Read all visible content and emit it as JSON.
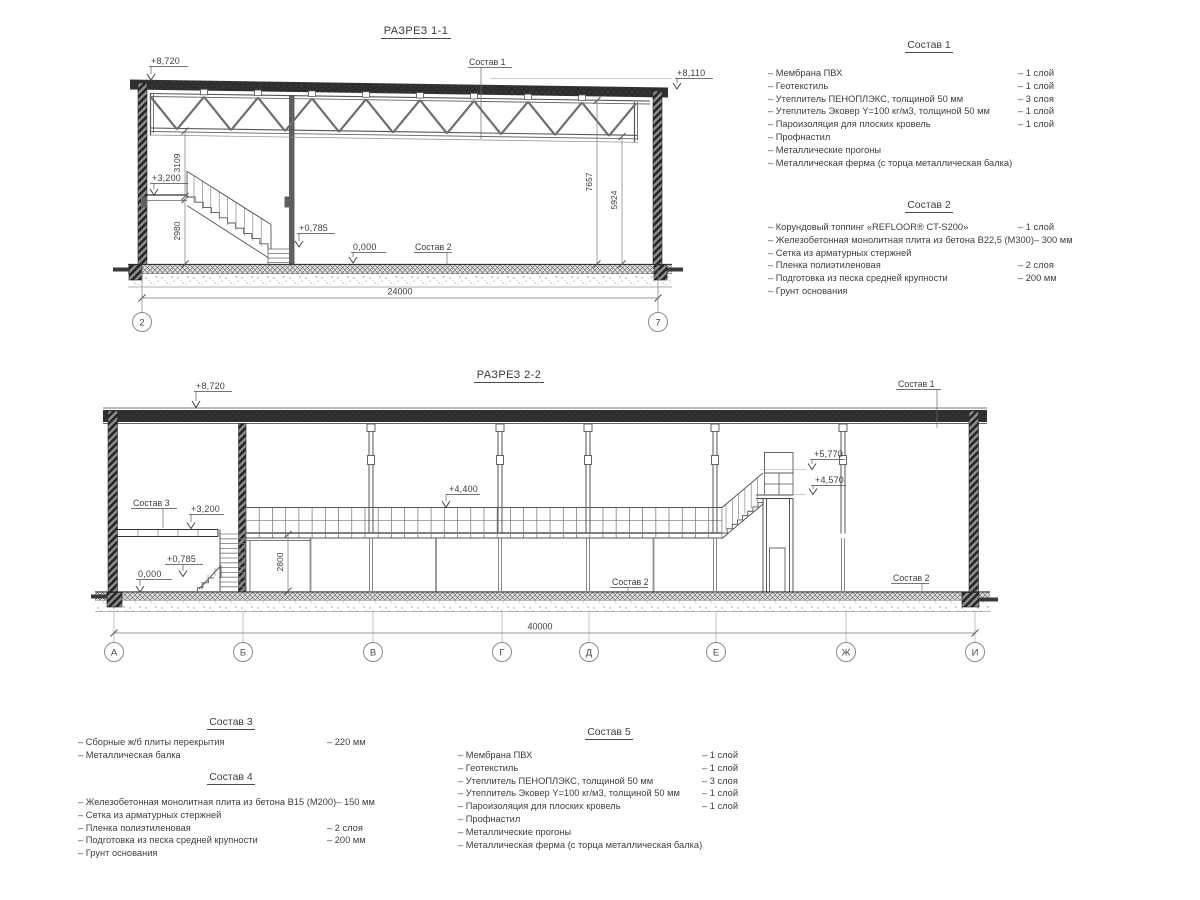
{
  "s11": {
    "title": "РАЗРЕЗ 1-1",
    "levels": {
      "roof_left": "+8,720",
      "roof_right": "+8,110",
      "landing": "+3,200",
      "stair": "+0,785",
      "floor": "0,000"
    },
    "callouts": {
      "roof": "Состав 1",
      "floor": "Состав 2"
    },
    "dims": {
      "truss_to_landing": "3109",
      "landing_to_floor": "2980",
      "right_outer": "7657",
      "right_inner": "5924",
      "span": "24000"
    },
    "grids": [
      "2",
      "7"
    ]
  },
  "s22": {
    "title": "РАЗРЕЗ 2-2",
    "levels": {
      "roof": "+8,720",
      "walkway": "+4,400",
      "stair_rail": "+5,770",
      "stair_platform": "+4,570",
      "mezzanine": "+3,200",
      "stair": "+0,785",
      "floor": "0,000"
    },
    "callouts": {
      "roof": "Состав 1",
      "mezzanine": "Состав 3",
      "floor_left": "Состав 2",
      "floor_right": "Состав 2"
    },
    "dims": {
      "span": "40000",
      "door": "2800"
    },
    "grids": [
      "А",
      "Б",
      "В",
      "Г",
      "Д",
      "Е",
      "Ж",
      "И"
    ]
  },
  "legends": [
    {
      "title": "Состав 1",
      "items": [
        {
          "name": "– Мембрана ПВХ",
          "qty": "– 1 слой"
        },
        {
          "name": "– Геотекстиль",
          "qty": "– 1 слой"
        },
        {
          "name": "– Утеплитель ПЕНОПЛЭКС, толщиной 50 мм",
          "qty": "– 3 слоя"
        },
        {
          "name": "– Утеплитель Эковер Y=100 кг/м3, толщиной 50 мм",
          "qty": "– 1 слой"
        },
        {
          "name": "– Пароизоляция для плоских кровель",
          "qty": "– 1 слой"
        },
        {
          "name": "– Профнастил",
          "qty": ""
        },
        {
          "name": "– Металлические прогоны",
          "qty": ""
        },
        {
          "name": "– Металлическая ферма (с торца металлическая балка)",
          "qty": ""
        }
      ]
    },
    {
      "title": "Состав 2",
      "items": [
        {
          "name": "– Корундовый топпинг «REFLOOR® CT-S200»",
          "qty": "– 1 слой"
        },
        {
          "name": "– Железобетонная  монолитная плита из бетона В22,5 (М300)",
          "qty": "– 300 мм"
        },
        {
          "name": "– Сетка из арматурных стержней",
          "qty": ""
        },
        {
          "name": "– Пленка полиэтиленовая",
          "qty": "– 2 слоя"
        },
        {
          "name": "– Подготовка из песка средней крупности",
          "qty": "– 200 мм"
        },
        {
          "name": "– Грунт основания",
          "qty": ""
        }
      ]
    },
    {
      "title": "Состав 3",
      "items": [
        {
          "name": "– Сборные ж/б плиты перекрытия",
          "qty": "– 220 мм"
        },
        {
          "name": "– Металлическая балка",
          "qty": ""
        }
      ]
    },
    {
      "title": "Состав 4",
      "items": [
        {
          "name": "– Железобетонная  монолитная плита из бетона В15 (М200)",
          "qty": "– 150 мм"
        },
        {
          "name": "– Сетка из арматурных стержней",
          "qty": ""
        },
        {
          "name": "– Пленка полиэтиленовая",
          "qty": "– 2 слоя"
        },
        {
          "name": "– Подготовка из песка средней крупности",
          "qty": "– 200 мм"
        },
        {
          "name": "– Грунт основания",
          "qty": ""
        }
      ]
    },
    {
      "title": "Состав 5",
      "items": [
        {
          "name": "– Мембрана ПВХ",
          "qty": "– 1 слой"
        },
        {
          "name": "– Геотекстиль",
          "qty": "– 1 слой"
        },
        {
          "name": "– Утеплитель ПЕНОПЛЭКС, толщиной 50 мм",
          "qty": "– 3 слоя"
        },
        {
          "name": "– Утеплитель Эковер Y=100 кг/м3, толщиной 50 мм",
          "qty": "– 1 слой"
        },
        {
          "name": "– Пароизоляция для плоских кровель",
          "qty": "– 1 слой"
        },
        {
          "name": "– Профнастил",
          "qty": ""
        },
        {
          "name": "– Металлические прогоны",
          "qty": ""
        },
        {
          "name": "– Металлическая ферма (с торца металлическая балка)",
          "qty": ""
        }
      ]
    }
  ]
}
